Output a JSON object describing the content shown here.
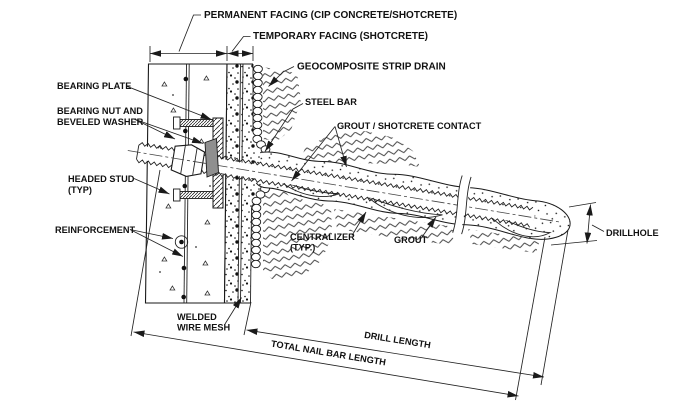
{
  "labels": {
    "permanent_facing": "PERMANENT FACING (CIP CONCRETE/SHOTCRETE)",
    "temporary_facing": "TEMPORARY FACING (SHOTCRETE)",
    "geocomposite": "GEOCOMPOSITE STRIP DRAIN",
    "steel_bar": "STEEL BAR",
    "grout_shotcrete_contact": "GROUT / SHOTCRETE CONTACT",
    "bearing_plate": "BEARING PLATE",
    "bearing_nut_line1": "BEARING NUT AND",
    "bearing_nut_line2": "BEVELED WASHER",
    "headed_stud_line1": "HEADED STUD",
    "headed_stud_line2": "(TYP)",
    "reinforcement": "REINFORCEMENT",
    "welded_wire_mesh_line1": "WELDED",
    "welded_wire_mesh_line2": "WIRE MESH",
    "centralizer_line1": "CENTRALIZER",
    "centralizer_line2": "(TYP.)",
    "grout": "GROUT",
    "drillhole": "DRILLHOLE"
  },
  "dimensions": {
    "drill_length": "DRILL LENGTH",
    "total_nail_bar_length": "TOTAL NAIL BAR LENGTH"
  },
  "colors": {
    "line": "#1a1a1a",
    "washer_fill": "#8f8f8f",
    "background": "#ffffff"
  }
}
